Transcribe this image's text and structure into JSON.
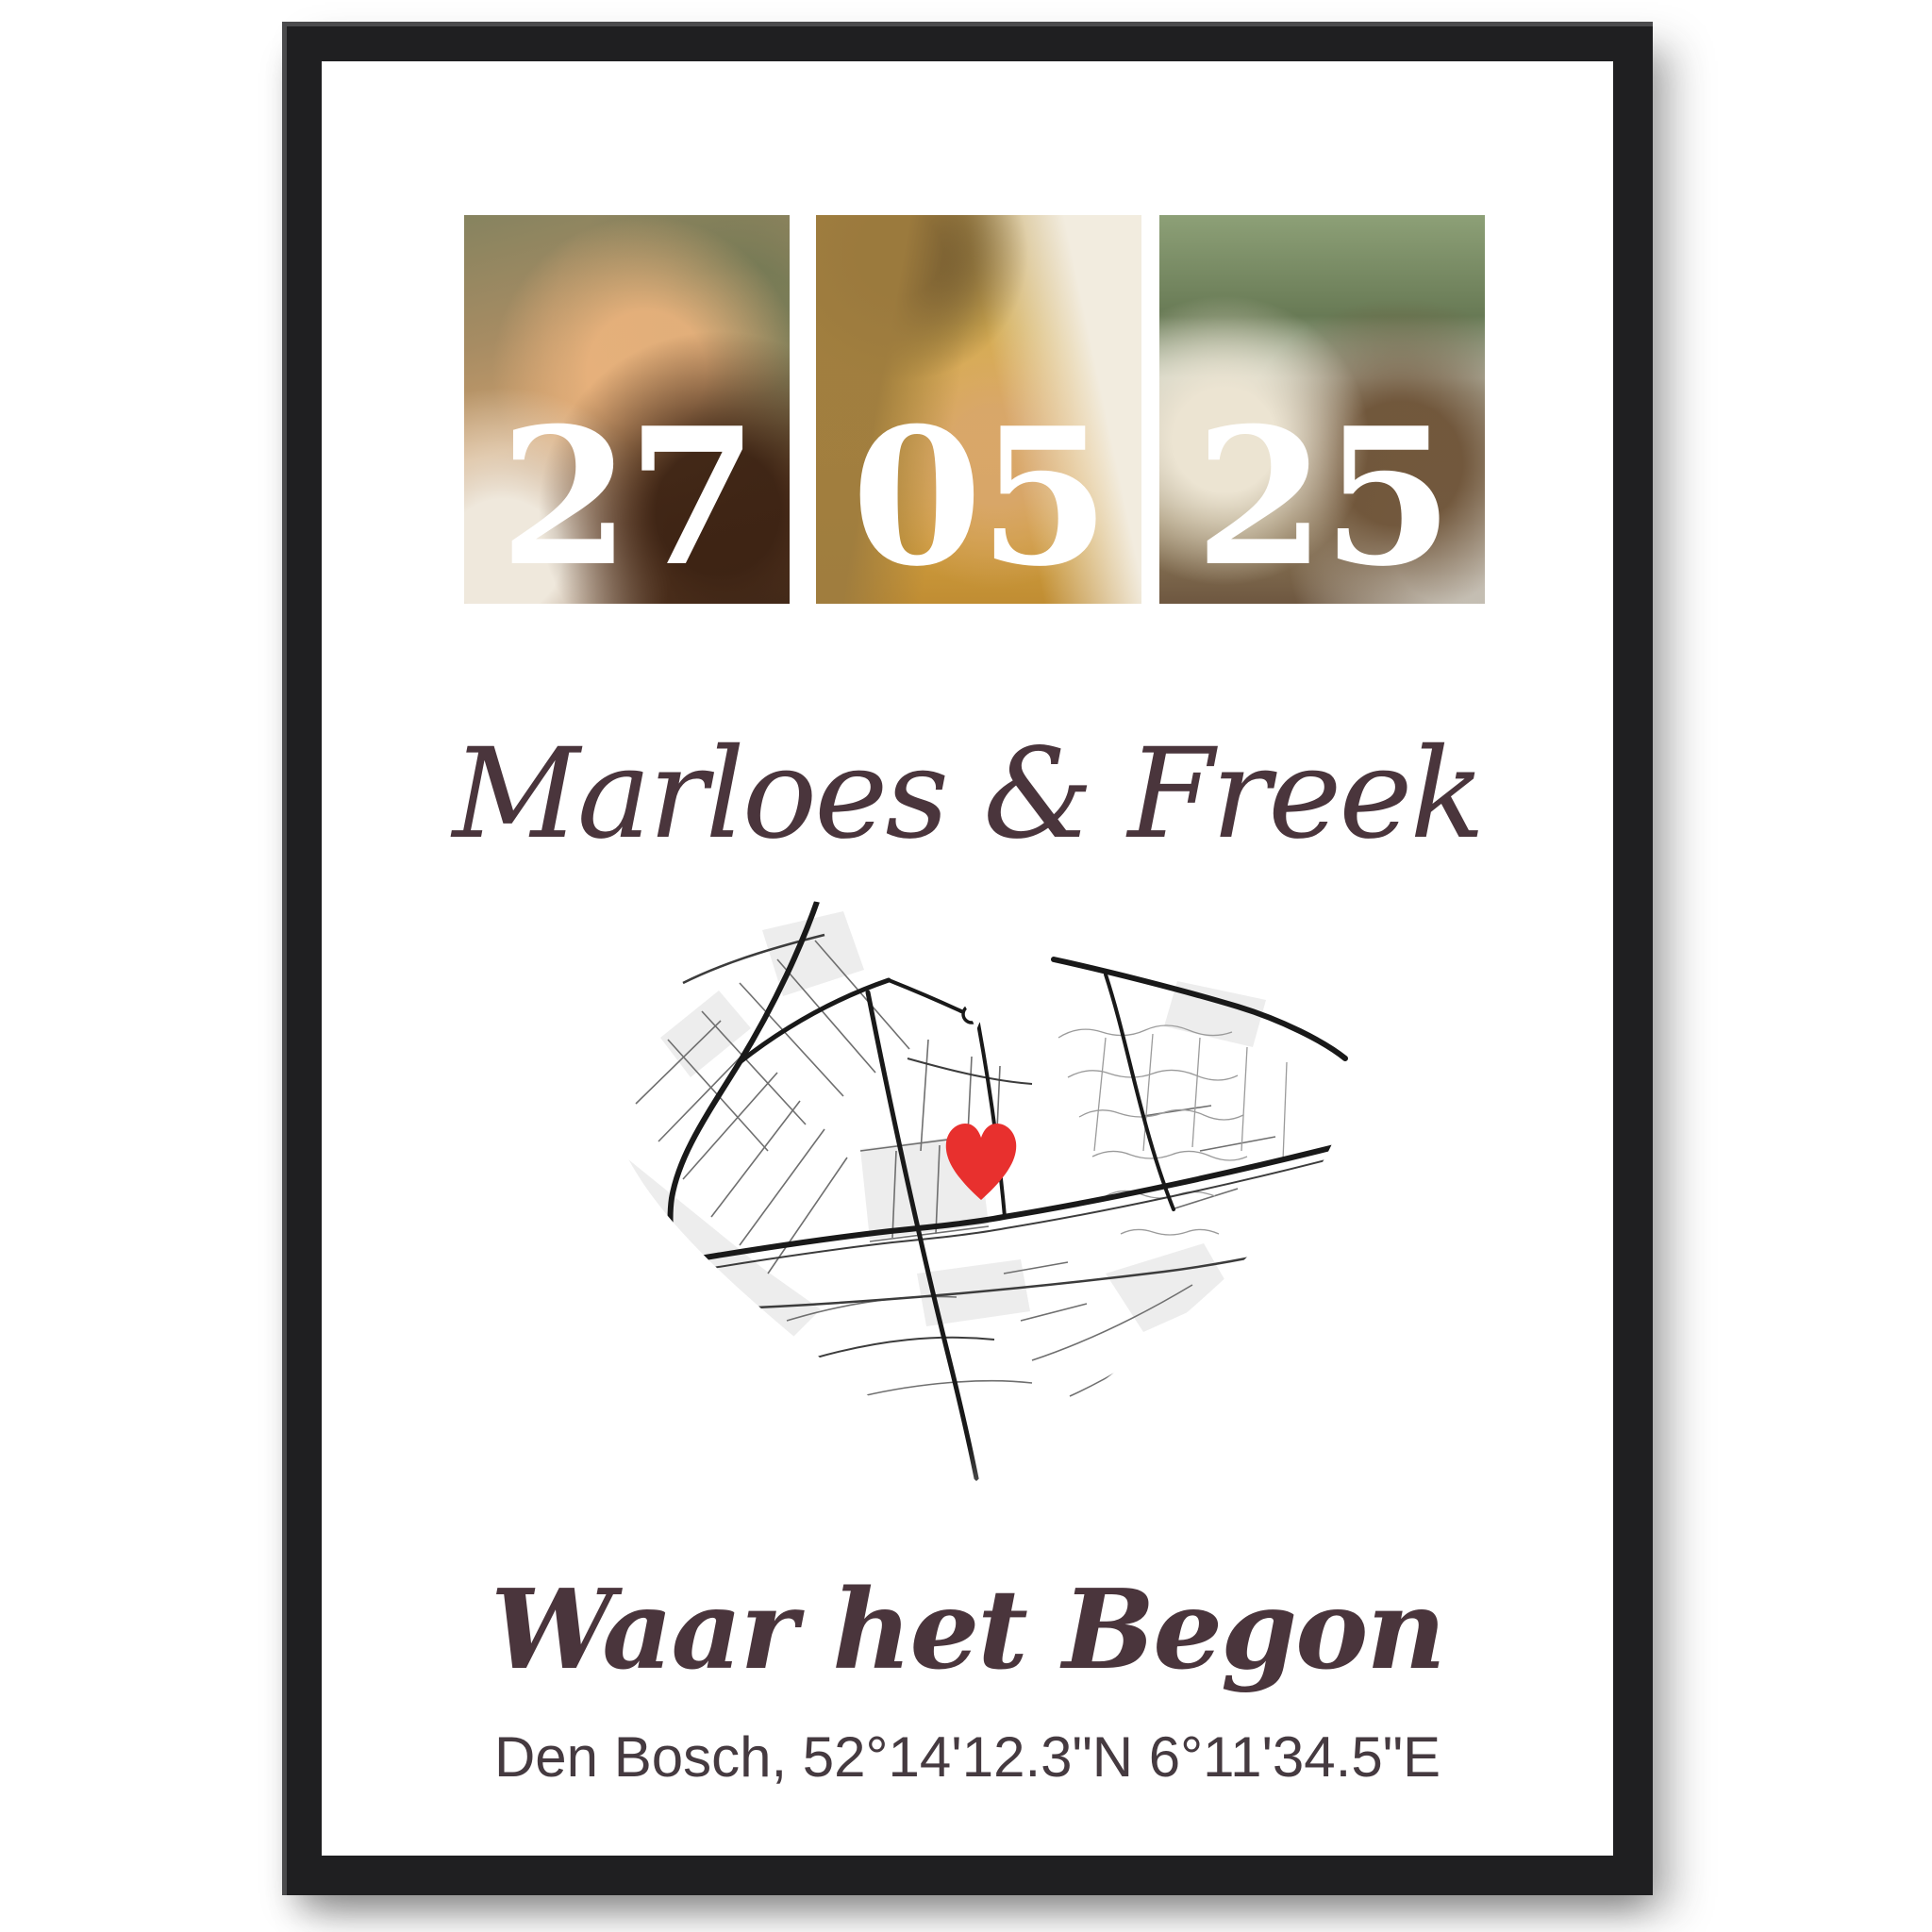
{
  "scene": {
    "background_color": "#ffffff",
    "frame_color": "#1f1f21"
  },
  "poster": {
    "background_color": "#ffffff",
    "date": {
      "day": "27",
      "month": "05",
      "year": "25",
      "color": "#ffffff"
    },
    "names": {
      "text": "Marloes & Freek",
      "color": "#4a353c"
    },
    "title": {
      "text": "Waar het Begon",
      "color": "#4a353c"
    },
    "coordinates": {
      "text": "Den Bosch, 52°14'12.3\"N 6°11'34.5\"E",
      "color": "#453a40"
    },
    "map": {
      "marker_color": "#e8302e",
      "bold_road_color": "#191919",
      "mid_road_color": "#3c3c3c",
      "street_color": "#6f6f6f",
      "light_street_color": "#9b9b9b",
      "block_color": "#ededed"
    }
  }
}
